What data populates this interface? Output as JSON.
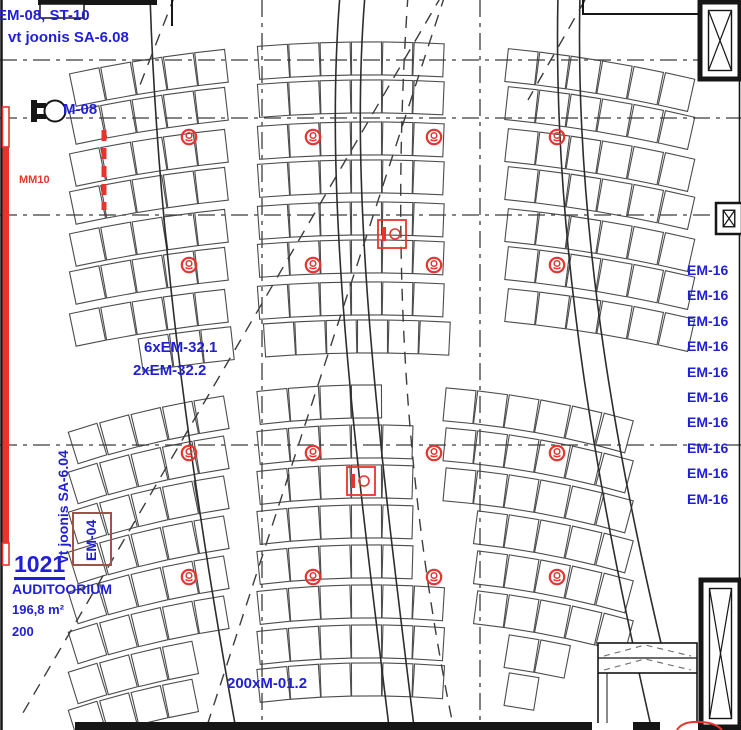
{
  "colors": {
    "annotation_blue": "#1f1fd8",
    "marker_red": "#e8342c",
    "em04_box_border": "#a0524a",
    "line_dark": "#1a1a1a"
  },
  "labels": {
    "top_left_line1": "EM-08, ST-10",
    "top_left_line2": "vt joonis SA-6.08",
    "motor": "M-08",
    "mm10": "MM10",
    "fixture_group_line1": "6xEM-32.1",
    "fixture_group_line2": "2xEM-32.2",
    "rotated_reference": "vt joonis SA-6.04",
    "em04": "EM-04",
    "seat_type": "200xM-01.2"
  },
  "room": {
    "number": "1021",
    "name": "AUDITOORIUM",
    "area": "196,8 m²",
    "capacity": "200"
  },
  "right_labels": {
    "em16": [
      "EM-16",
      "EM-16",
      "EM-16",
      "EM-16",
      "EM-16",
      "EM-16",
      "EM-16",
      "EM-16",
      "EM-16",
      "EM-16"
    ]
  },
  "plan": {
    "seat_banks": 2,
    "seat_rows_upper": 8,
    "seat_rows_lower": 8,
    "speaker_count": 16,
    "ceiling_device_count": 2
  }
}
